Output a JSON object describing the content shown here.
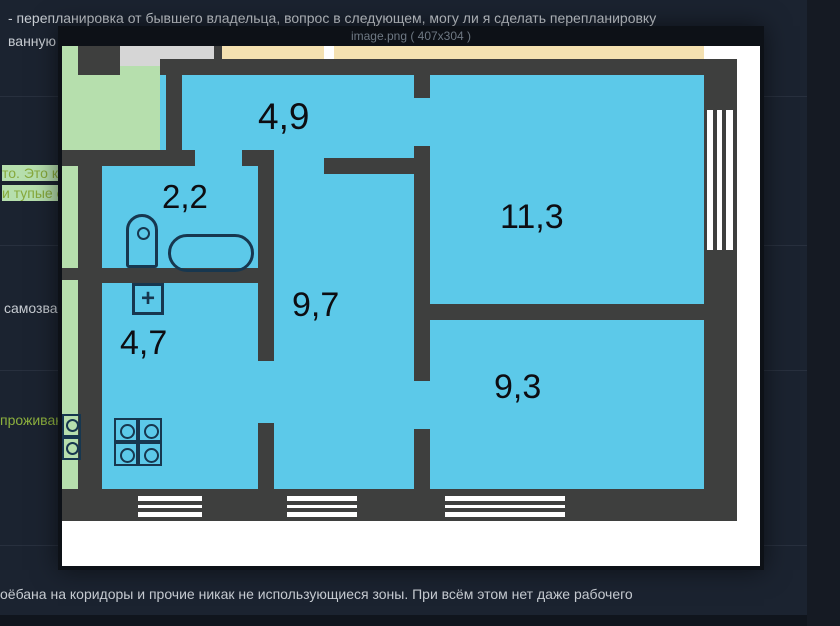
{
  "page": {
    "messages": {
      "top_line": "- перепланировка от бывшего владельца, вопрос в следующем, могу ли я сделать перепланировку",
      "top_line_continued": "ванную",
      "left_fragment_1": "то. Это к",
      "left_fragment_2": "и тупые с",
      "left_fragment_3": "самозван",
      "left_fragment_4": "проживан",
      "bottom_line": "оёбана на коридоры и прочие никак не использующиеся зоны. При всём этом нет даже рабочего"
    },
    "colors": {
      "background": "#1b2330",
      "gutter": "#151a23",
      "text_gray": "#c7ccd2",
      "text_green": "#87a93c"
    }
  },
  "modal": {
    "title": "image.png ( 407x304 )",
    "colors": {
      "titlebar": "#0d1117",
      "title_text": "#6e7883"
    }
  },
  "floorplan": {
    "rooms": [
      {
        "name": "hallway-top",
        "area_label": "4,9"
      },
      {
        "name": "bathroom",
        "area_label": "2,2"
      },
      {
        "name": "hallway-main",
        "area_label": "9,7"
      },
      {
        "name": "room-large",
        "area_label": "11,3"
      },
      {
        "name": "kitchen",
        "area_label": "4,7"
      },
      {
        "name": "room-small",
        "area_label": "9,3"
      }
    ],
    "sink_symbol": "+",
    "colors": {
      "wall": "#3e3f3e",
      "room_blue": "#5cc9e9",
      "balcony_green": "#b6dfad",
      "loggia_beige": "#f4e1b1",
      "strip_gray": "#d6d6d6",
      "fixture_outline": "#17374f",
      "label_text": "#0d0d12"
    }
  }
}
